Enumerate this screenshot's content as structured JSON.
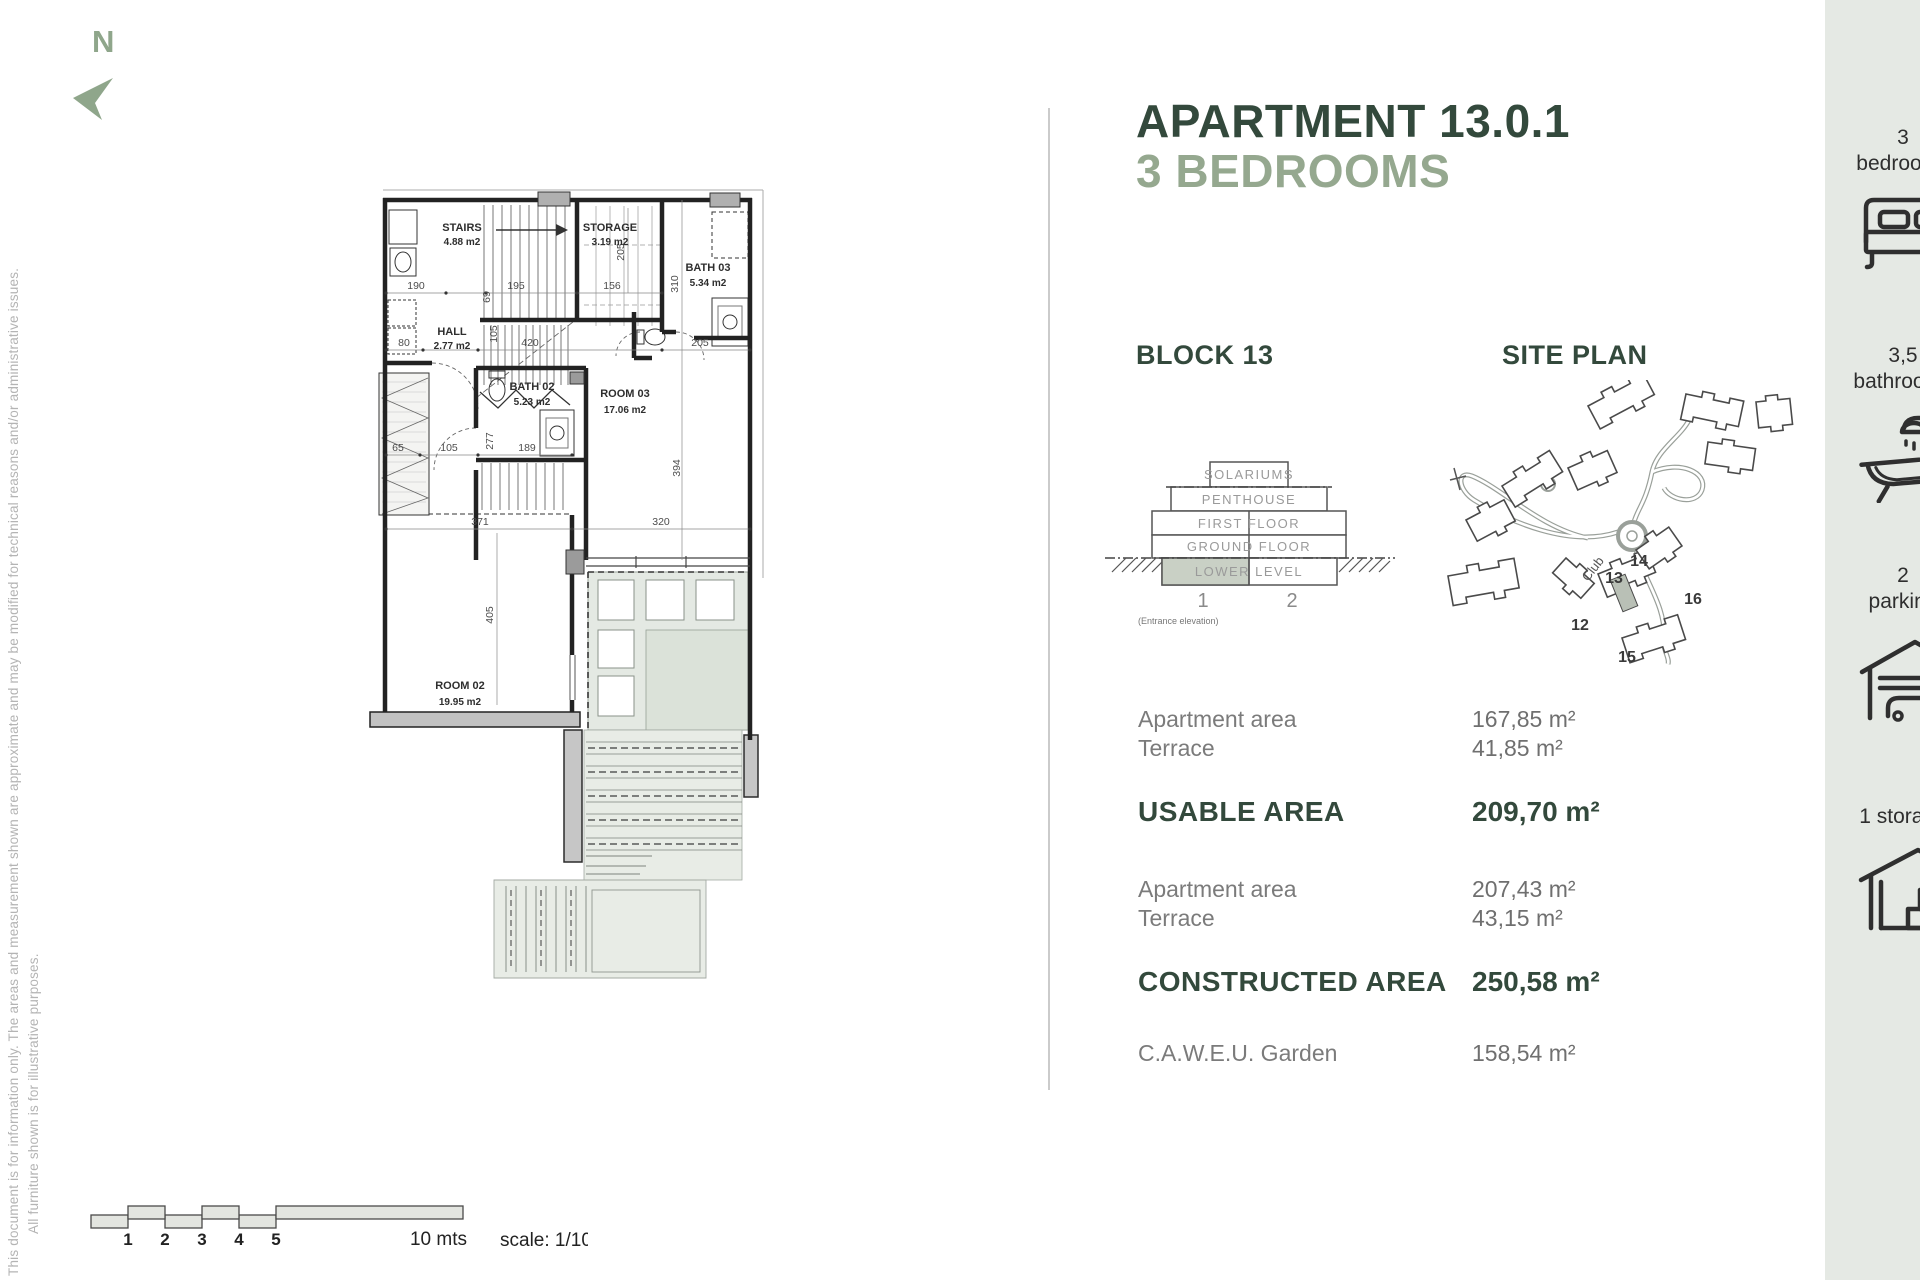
{
  "disclaimer": {
    "line1": "This document is for information only. The areas and measurement shown are approximate and may be modified for technical reasons and/or administrative issues.",
    "line2": "All furniture shown is for illustrative purposes."
  },
  "compass": {
    "label": "N"
  },
  "header": {
    "title_line1": "APARTMENT 13.0.1",
    "title_line2": "3 BEDROOMS"
  },
  "block_section": {
    "heading": "BLOCK 13",
    "levels": [
      "SOLARIUMS",
      "PENTHOUSE",
      "FIRST FLOOR",
      "GROUND FLOOR",
      "LOWER LEVEL"
    ],
    "unit_labels": [
      "1",
      "2"
    ],
    "caption": "(Entrance elevation)"
  },
  "site_plan": {
    "heading": "SITE PLAN",
    "club_label": "Club",
    "block_numbers": [
      "12",
      "13",
      "14",
      "15",
      "16"
    ]
  },
  "areas": {
    "usable": {
      "rows": [
        {
          "label": "Apartment area",
          "value": "167,85 m²"
        },
        {
          "label": "Terrace",
          "value": "41,85 m²"
        }
      ],
      "total_label": "USABLE AREA",
      "total_value": "209,70 m²"
    },
    "constructed": {
      "rows": [
        {
          "label": "Apartment area",
          "value": "207,43 m²"
        },
        {
          "label": "Terrace",
          "value": "43,15 m²"
        }
      ],
      "total_label": "CONSTRUCTED AREA",
      "total_value": "250,58 m²"
    },
    "garden": {
      "label": "C.A.W.E.U. Garden",
      "value": "158,54 m²"
    }
  },
  "sidebar": {
    "items": [
      {
        "line1": "3",
        "line2": "bedrooms"
      },
      {
        "line1": "3,5",
        "line2": "bathrooms"
      },
      {
        "line1": "2",
        "line2": "parking"
      },
      {
        "line1": "1 storage",
        "line2": ""
      }
    ]
  },
  "floorplan": {
    "rooms": [
      {
        "name": "STAIRS",
        "area": "4.88 m2"
      },
      {
        "name": "STORAGE",
        "area": "3.19 m2"
      },
      {
        "name": "BATH 03",
        "area": "5.34 m2"
      },
      {
        "name": "HALL",
        "area": "2.77 m2"
      },
      {
        "name": "BATH 02",
        "area": "5.23 m2"
      },
      {
        "name": "ROOM 03",
        "area": "17.06 m2"
      },
      {
        "name": "ROOM 02",
        "area": "19.95 m2"
      }
    ],
    "dimensions": {
      "d190": "190",
      "d69": "69",
      "d195": "195",
      "d156": "156",
      "d205v": "205",
      "d310": "310",
      "d80": "80",
      "d105v": "105",
      "d420": "420",
      "d205": "205",
      "d65": "65",
      "d105": "105",
      "d277": "277",
      "d189": "189",
      "d394": "394",
      "d371": "371",
      "d320": "320",
      "d405": "405"
    }
  },
  "scalebar": {
    "ticks": [
      "1",
      "2",
      "3",
      "4",
      "5"
    ],
    "end_label": "10 mts",
    "scale_label": "scale: 1/100"
  }
}
